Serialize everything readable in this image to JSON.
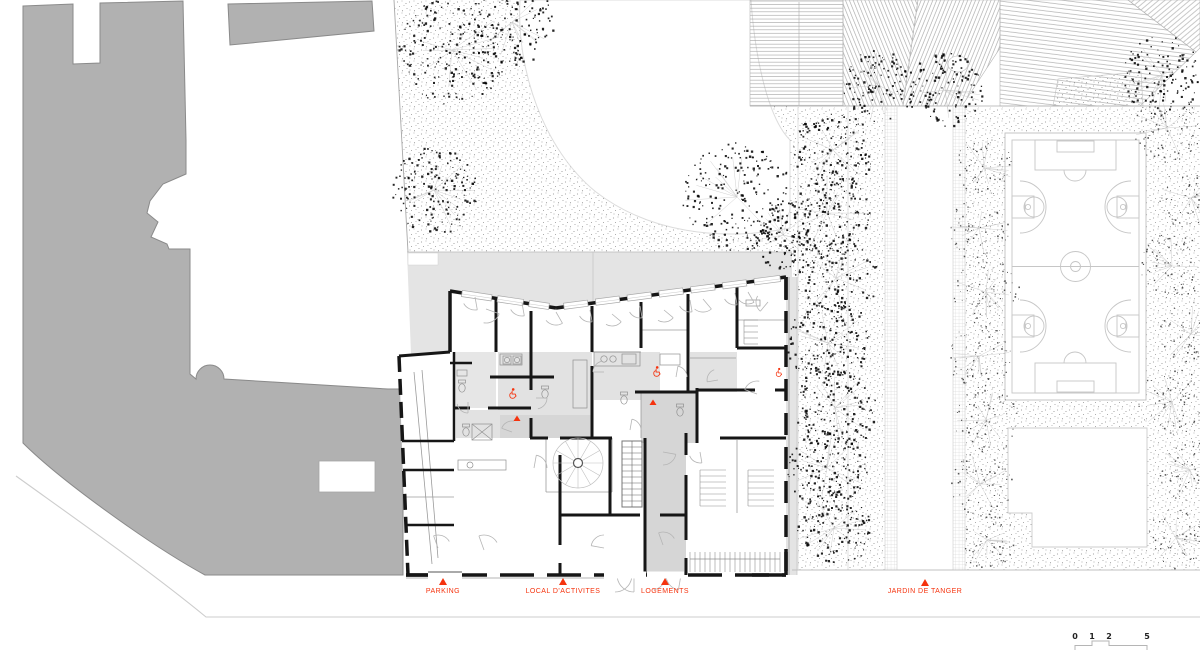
{
  "plan": {
    "markers": [
      {
        "id": "parking",
        "label": "PARKING"
      },
      {
        "id": "local-activites",
        "label": "LOCAL D'ACTIVITES"
      },
      {
        "id": "logements",
        "label": "LOGEMENTS"
      },
      {
        "id": "jardin-tanger",
        "label": "JARDIN DE TANGER"
      }
    ],
    "scale_bar": {
      "ticks": [
        "0",
        "1",
        "2",
        "5"
      ]
    },
    "colors": {
      "accent_red": "#f5330e",
      "mass_gray": "#b1b1b1",
      "tint_gray": "#e4e4e4",
      "wall_black": "#161616",
      "court_line": "#c6c6c6"
    },
    "icons": {
      "entrance_marker": "direction-triangle-icon",
      "accessibility": "wheelchair-icon"
    }
  }
}
